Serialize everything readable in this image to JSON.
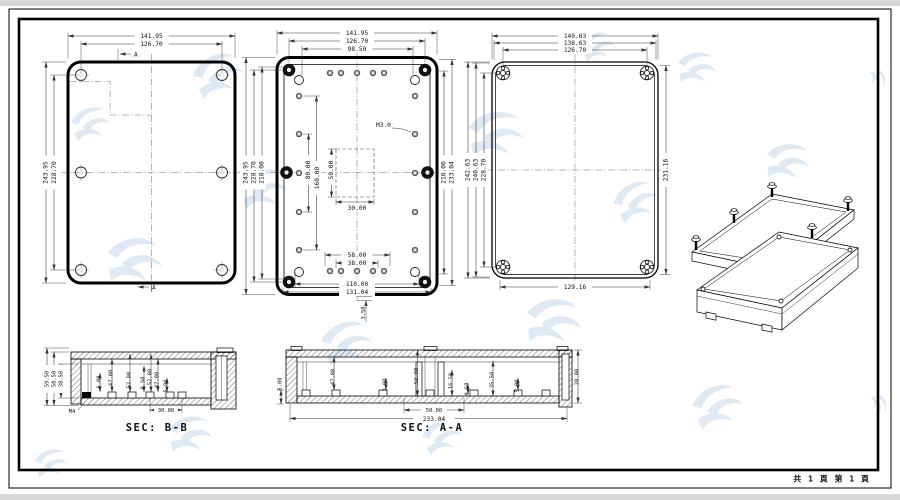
{
  "footer": {
    "page_info": "共 1 頁  第 1 頁"
  },
  "lid_view": {
    "width_outer": "141.95",
    "width_holes": "126.70",
    "height_outer": "243.95",
    "height_holes": "228.70",
    "section_a_top": "A",
    "section_a_bottom": "A"
  },
  "base_view": {
    "top_dims": [
      "141.95",
      "126.70",
      "98.50"
    ],
    "left_dims": [
      "243.95",
      "228.70",
      "218.00"
    ],
    "inner_vertical_dims": [
      "80.00",
      "160.00",
      "50.00"
    ],
    "inner_width_dim": "30.00",
    "bottom_dims": [
      "58.00",
      "38.00",
      "110.00",
      "131.04"
    ],
    "right_dims": [
      "210.00",
      "233.04"
    ],
    "thread_label": "M3.0",
    "lip_dim": "3.50"
  },
  "cover_view": {
    "top_dims": [
      "140.63",
      "138.63",
      "126.70"
    ],
    "left_dims": [
      "242.63",
      "240.63",
      "228.70"
    ],
    "right_dim": "231.16",
    "bottom_dim": "129.16"
  },
  "section_bb": {
    "title": "SEC: B-B",
    "left_dims": [
      "59.50",
      "58.50",
      "38.50"
    ],
    "feature_dims": [
      "6.00",
      "47.00",
      "52.00",
      "0.50",
      "52.00",
      "47.00",
      "5.00"
    ],
    "bottom_dim": "30.00",
    "thread_label": "M4"
  },
  "section_aa": {
    "title": "SEC: A-A",
    "left_dim": "6.00",
    "feature_dims": [
      "47.00",
      "3.00",
      "52.00",
      "16.50",
      "0.50",
      "35.50",
      "5.00"
    ],
    "right_dim": "20.00",
    "bottom_dims": [
      "50.00",
      "233.04"
    ]
  }
}
